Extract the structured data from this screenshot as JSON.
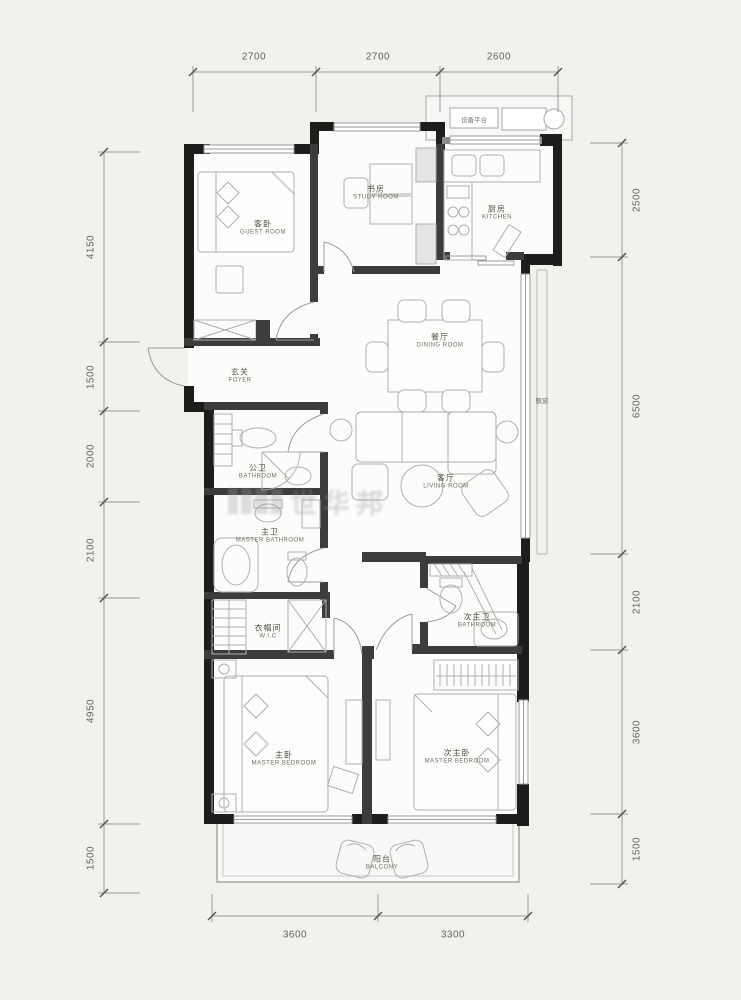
{
  "rooms": {
    "guest": {
      "zh": "客卧",
      "en": "GUEST ROOM"
    },
    "study": {
      "zh": "书房",
      "en": "STUDY ROOM"
    },
    "kitchen": {
      "zh": "厨房",
      "en": "KITCHEN"
    },
    "dining": {
      "zh": "餐厅",
      "en": "DINING ROOM"
    },
    "living": {
      "zh": "客厅",
      "en": "LIVING ROOM"
    },
    "foyer": {
      "zh": "玄关",
      "en": "FOYER"
    },
    "bathroom": {
      "zh": "公卫",
      "en": "BATHROOM"
    },
    "master_bathroom": {
      "zh": "主卫",
      "en": "MASTER BATHROOM"
    },
    "wic": {
      "zh": "衣帽间",
      "en": "W.I.C"
    },
    "master_bedroom": {
      "zh": "主卧",
      "en": "MASTER BEDROOM"
    },
    "second_master_bedroom": {
      "zh": "次主卧",
      "en": "MASTER BEDROOM"
    },
    "second_bathroom": {
      "zh": "次主卫",
      "en": "BATHROOM"
    },
    "balcony": {
      "zh": "阳台",
      "en": "BALCONY"
    },
    "equipment_platform": {
      "zh": "设备平台"
    },
    "bay_window": {
      "zh": "飘窗"
    }
  },
  "dimensions": {
    "top": [
      "2700",
      "2700",
      "2600"
    ],
    "bottom": [
      "3600",
      "3300"
    ],
    "left": [
      "4150",
      "1500",
      "2000",
      "2100",
      "4950",
      "1500"
    ],
    "right": [
      "2500",
      "6500",
      "2100",
      "3600",
      "1500"
    ]
  },
  "watermark": {
    "text": "世华邦"
  },
  "colors": {
    "wall": "#1d1d1b",
    "interior_wall": "#3c3c3a",
    "background": "#f2f1ee",
    "floor": "#fcfcfa",
    "furniture_line": "#b0b0ae",
    "dimension_line": "#8f8f8d"
  }
}
